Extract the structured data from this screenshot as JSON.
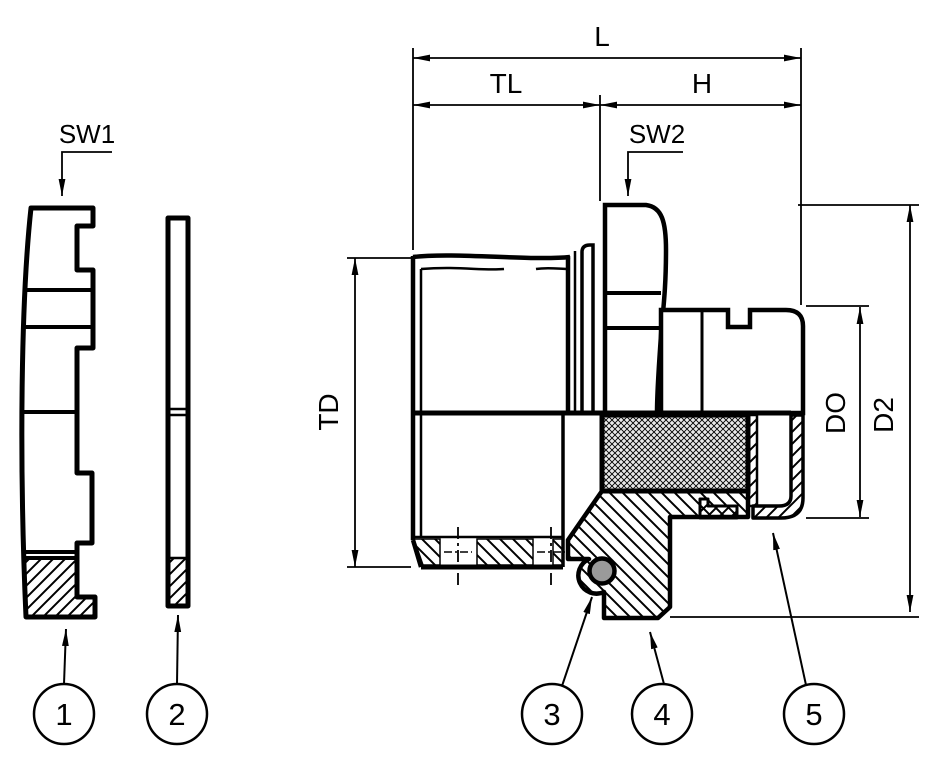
{
  "drawing": {
    "dimension_labels": {
      "overall_length": "L",
      "thread_length": "TL",
      "body_height": "H",
      "wrench_size_1": "SW1",
      "wrench_size_2": "SW2",
      "thread_diameter": "TD",
      "bore_diameter": "DO",
      "outer_diameter": "D2"
    },
    "callouts": [
      {
        "number": "1"
      },
      {
        "number": "2"
      },
      {
        "number": "3"
      },
      {
        "number": "4"
      },
      {
        "number": "5"
      }
    ],
    "colors": {
      "line": "#000000",
      "o_ring_fill": "#9a9a9a",
      "seal_insert_tint": "#e9e9e9",
      "background": "#ffffff"
    }
  }
}
